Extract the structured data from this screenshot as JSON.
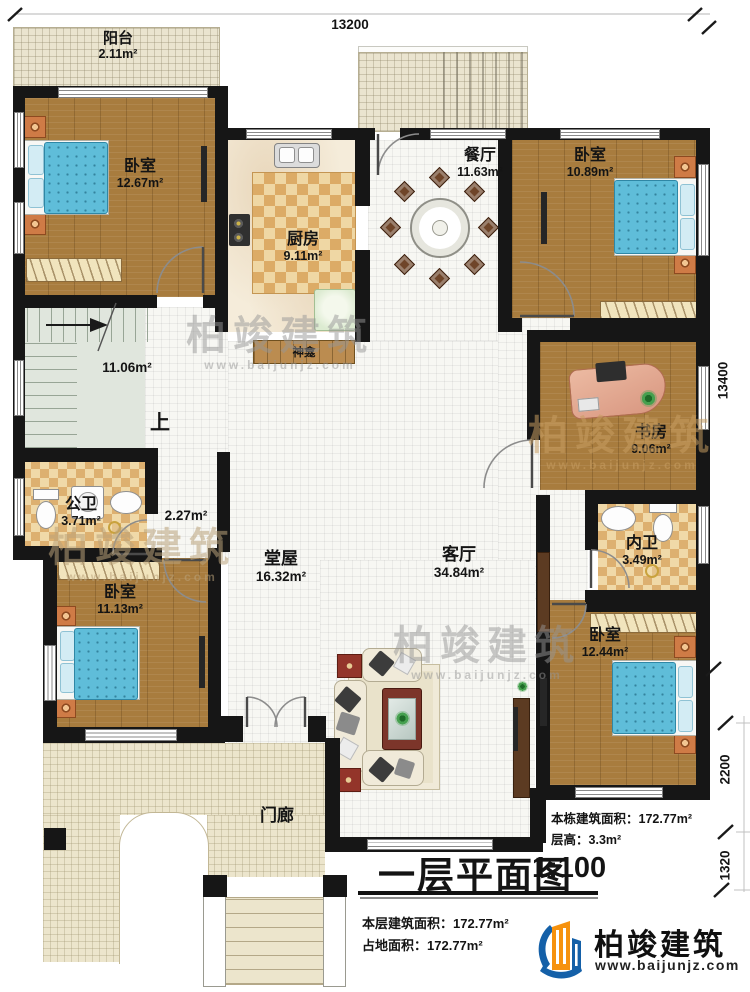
{
  "dimensions": {
    "top": "13200",
    "side": "13400",
    "side_lower": "2200",
    "side_bottom": "1320"
  },
  "rooms": {
    "balcony": {
      "name": "阳台",
      "area": "2.11m²"
    },
    "bedroom_nw": {
      "name": "卧室",
      "area": "12.67m²"
    },
    "kitchen": {
      "name": "厨房",
      "area": "9.11m²"
    },
    "dining": {
      "name": "餐厅",
      "area": "11.63m²"
    },
    "bedroom_ne": {
      "name": "卧室",
      "area": "10.89m²"
    },
    "stairwell": {
      "area": "11.06m²",
      "direction": "上"
    },
    "shrine": {
      "name": "神龛"
    },
    "corridor": {
      "area": "2.27m²"
    },
    "bath_public": {
      "name": "公卫",
      "area": "3.71m²"
    },
    "hall": {
      "name": "堂屋",
      "area": "16.32m²"
    },
    "living": {
      "name": "客厅",
      "area": "34.84m²"
    },
    "study": {
      "name": "书房",
      "area": "9.06m²"
    },
    "bath_private": {
      "name": "内卫",
      "area": "3.49m²"
    },
    "bedroom_sw": {
      "name": "卧室",
      "area": "11.13m²"
    },
    "bedroom_se": {
      "name": "卧室",
      "area": "12.44m²"
    },
    "porch": {
      "name": "门廊"
    }
  },
  "title": {
    "text": "一层平面图",
    "scale": "1:100"
  },
  "stats": {
    "building_area": {
      "label": "本栋建筑面积：",
      "value": "172.77m²"
    },
    "floor_height": {
      "label": "层高：",
      "value": "3.3m²"
    },
    "floor_area": {
      "label": "本层建筑面积：",
      "value": "172.77m²"
    },
    "land_area": {
      "label": "占地面积：",
      "value": "172.77m²"
    }
  },
  "brand": {
    "name": "柏竣建筑",
    "site": "www.baijunjz.com"
  },
  "watermark": {
    "text": "柏竣建筑",
    "site": "www.baijunjz.com"
  },
  "colors": {
    "wall": "#161616",
    "wood_floor": "#a87c3e",
    "bed": "#5fbdd9",
    "logo_blue": "#1460a8",
    "logo_orange": "#f6920e"
  }
}
